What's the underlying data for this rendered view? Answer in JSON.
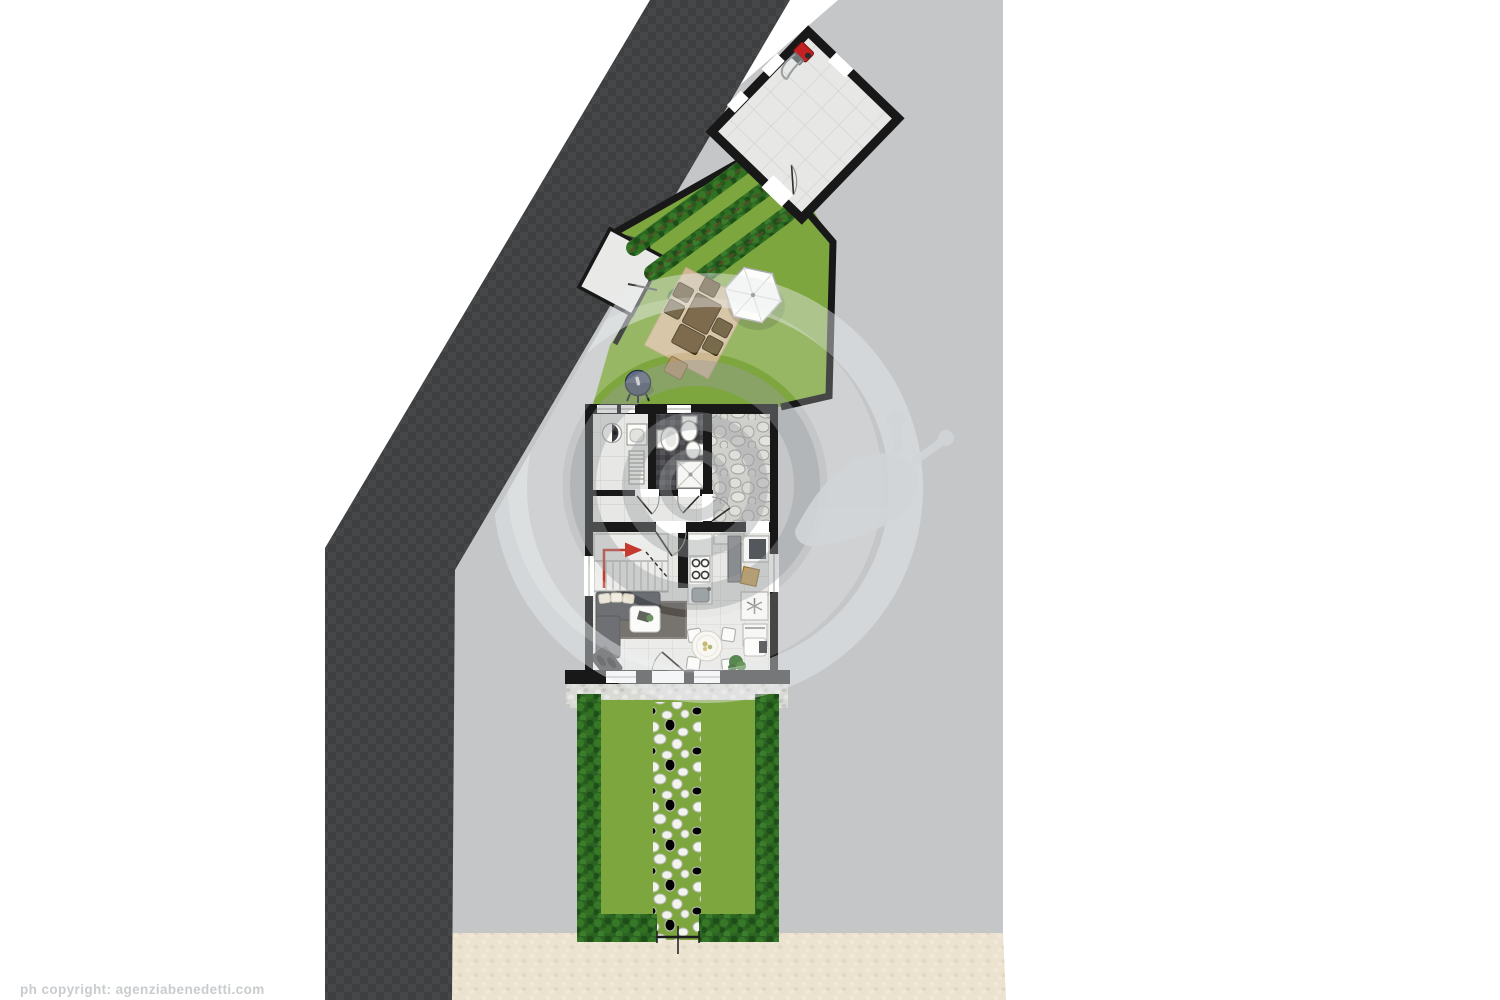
{
  "footer": {
    "copyright": "ph copyright: agenziabenedetti.com"
  },
  "palette": {
    "background": "#ffffff",
    "parcel": "#c4c6c8",
    "road": "#3d3f41",
    "sidewalk": "#ebe2cf",
    "wall": "#181818",
    "lawn": "#7da63f",
    "hedge": "#2b6322",
    "floor_tile": "#e7e7e5",
    "bath_mosaic": "#47474b",
    "cobblestone": "#cfcfcb",
    "patio": "#d3b996",
    "table_wood": "#5e4521",
    "umbrella": "#fdfdfb",
    "stair_arrow": "#c43a2e",
    "sofa": "#4a4d52",
    "grill": "#4a566b",
    "mower": "#c32222",
    "watermark": "#9a9da0"
  },
  "plan": {
    "areas": [
      "road",
      "neighboring-parcel",
      "sidewalk",
      "garage",
      "upper-garden",
      "laundry-room",
      "bathroom",
      "hallway",
      "courtyard",
      "staircase",
      "living-room",
      "kitchen",
      "dining-area",
      "rear-garden"
    ],
    "objects": [
      "lawnmower",
      "planting-rows",
      "patio-rug",
      "garden-dining-set",
      "parasol",
      "grill",
      "concrete-pad",
      "washing-machine",
      "laundry-sink",
      "radiator",
      "washbasin",
      "toilet",
      "bidet",
      "shower",
      "sofa",
      "coffee-table",
      "stove",
      "kitchen-sink",
      "fridge",
      "freezer",
      "dishwasher",
      "round-dining-table",
      "potted-plant",
      "entry-mat",
      "stepping-stone-path",
      "hedges",
      "garden-gate",
      "snail-logo-watermark"
    ]
  }
}
